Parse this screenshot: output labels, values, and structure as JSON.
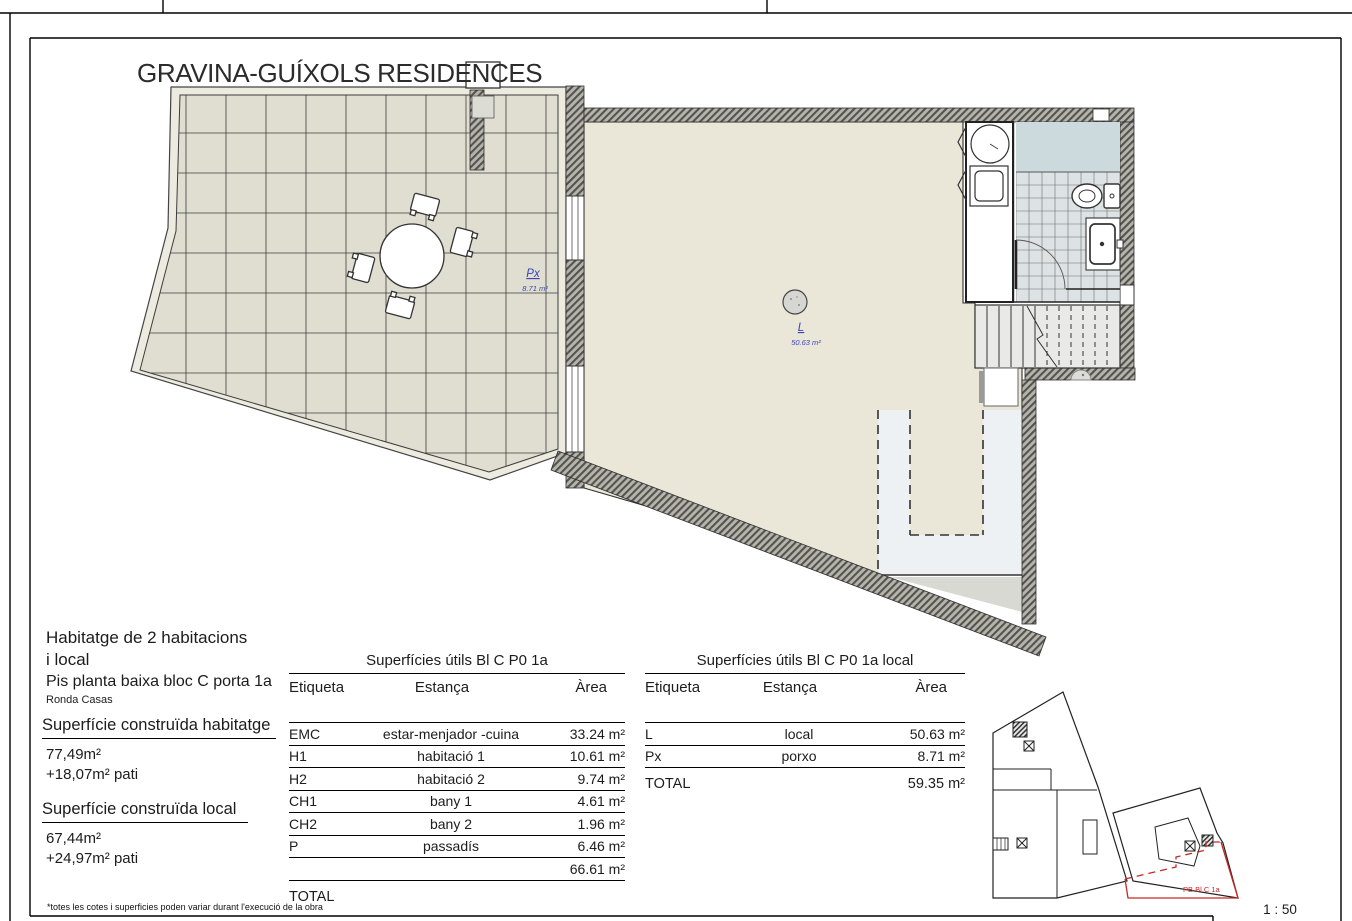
{
  "header": {
    "title": "GRAVINA-GUÍXOLS RESIDENCES"
  },
  "info": {
    "dwelling_line1": "Habitatge de 2 habitacions",
    "dwelling_line2": "i local",
    "subtitle": "Pis planta baixa bloc C porta 1a",
    "address": "Ronda Casas",
    "built_dwelling_label": "Superfície construïda habitatge",
    "built_dwelling_value": "77,49m²",
    "built_dwelling_patio": "+18,07m² pati",
    "built_local_label": "Superfície construïda local",
    "built_local_value": "67,44m²",
    "built_local_patio": "+24,97m² pati"
  },
  "area_tables": [
    {
      "title": "Superfícies útils Bl C P0 1a",
      "columns": [
        "Etiqueta",
        "Estança",
        "Àrea"
      ],
      "rows": [
        [
          "EMC",
          "estar-menjador -cuina",
          "33.24 m²"
        ],
        [
          "H1",
          "habitació 1",
          "10.61 m²"
        ],
        [
          "H2",
          "habitació 2",
          "9.74 m²"
        ],
        [
          "CH1",
          "bany 1",
          "4.61 m²"
        ],
        [
          "CH2",
          "bany 2",
          "1.96 m²"
        ],
        [
          "P",
          "passadís",
          "6.46 m²"
        ],
        [
          "",
          "",
          "66.61 m²"
        ]
      ],
      "total_label": "TOTAL",
      "total_value": ""
    },
    {
      "title": "Superfícies útils Bl C P0 1a local",
      "columns": [
        "Etiqueta",
        "Estança",
        "Àrea"
      ],
      "rows": [
        [
          "L",
          "local",
          "50.63 m²"
        ],
        [
          "Px",
          "porxo",
          "8.71 m²"
        ]
      ],
      "total_label": "TOTAL",
      "total_value": "59.35 m²"
    }
  ],
  "plan_labels": {
    "porch_code": "Px",
    "porch_area": "8.71 m²",
    "local_code": "L",
    "local_area": "50.63 m²"
  },
  "siteplan": {
    "unit_label": "PB Bl C 1a"
  },
  "footer": {
    "disclaimer": "*totes les cotes i superficies poden variar durant l'execució de la obra",
    "scale": "1 : 50"
  },
  "colors": {
    "label_blue": "#3b44bb",
    "unit_red": "#c62828",
    "patio_tile": "#e0ded1",
    "room_fill": "#eae7d9",
    "bath_tile": "#dde3e4",
    "shower": "#ccdade"
  }
}
